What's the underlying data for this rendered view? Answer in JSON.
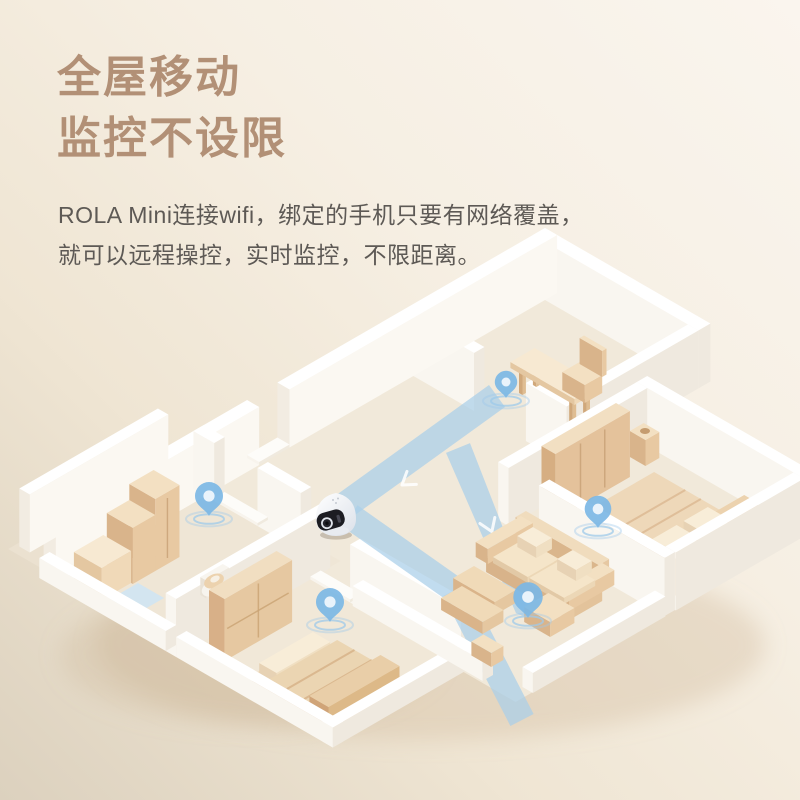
{
  "header": {
    "title_line1": "全屋移动",
    "title_line2": "监控不设限",
    "desc_line1": "ROLA Mini连接wifi，绑定的手机只要有网络覆盖，",
    "desc_line2": "就可以远程操控，实时监控，不限距离。"
  },
  "palette": {
    "bg_top_right": "#faf5ee",
    "bg_bottom_left": "#dcd1be",
    "title_color": "#b29076",
    "desc_color": "#5d5955",
    "path_blue": "#a9cee9",
    "pin_blue": "#7cb7e5",
    "pin_hole": "#e9f3fb",
    "ripple_blue": "#9ec9ea",
    "wall_white": "#ffffff",
    "wall_shade": "#efe9df",
    "floor_beige": "#f1e9da",
    "wood_tan": "#e8c9a2",
    "window_light": "#cfe4f3",
    "robot_body": "#fafbfd",
    "robot_face": "#1c1c22"
  },
  "illustration": {
    "type": "isometric-apartment-cutaway",
    "robot": "rola-mini-camera-robot",
    "pins": [
      "study-doorway-pin",
      "kitchen-pin",
      "small-bedroom-pin",
      "living-room-pin",
      "master-bedroom-pin"
    ],
    "rooms": [
      "study",
      "hallway",
      "master-bedroom",
      "living-room",
      "kitchen",
      "balcony",
      "small-bedroom"
    ]
  }
}
